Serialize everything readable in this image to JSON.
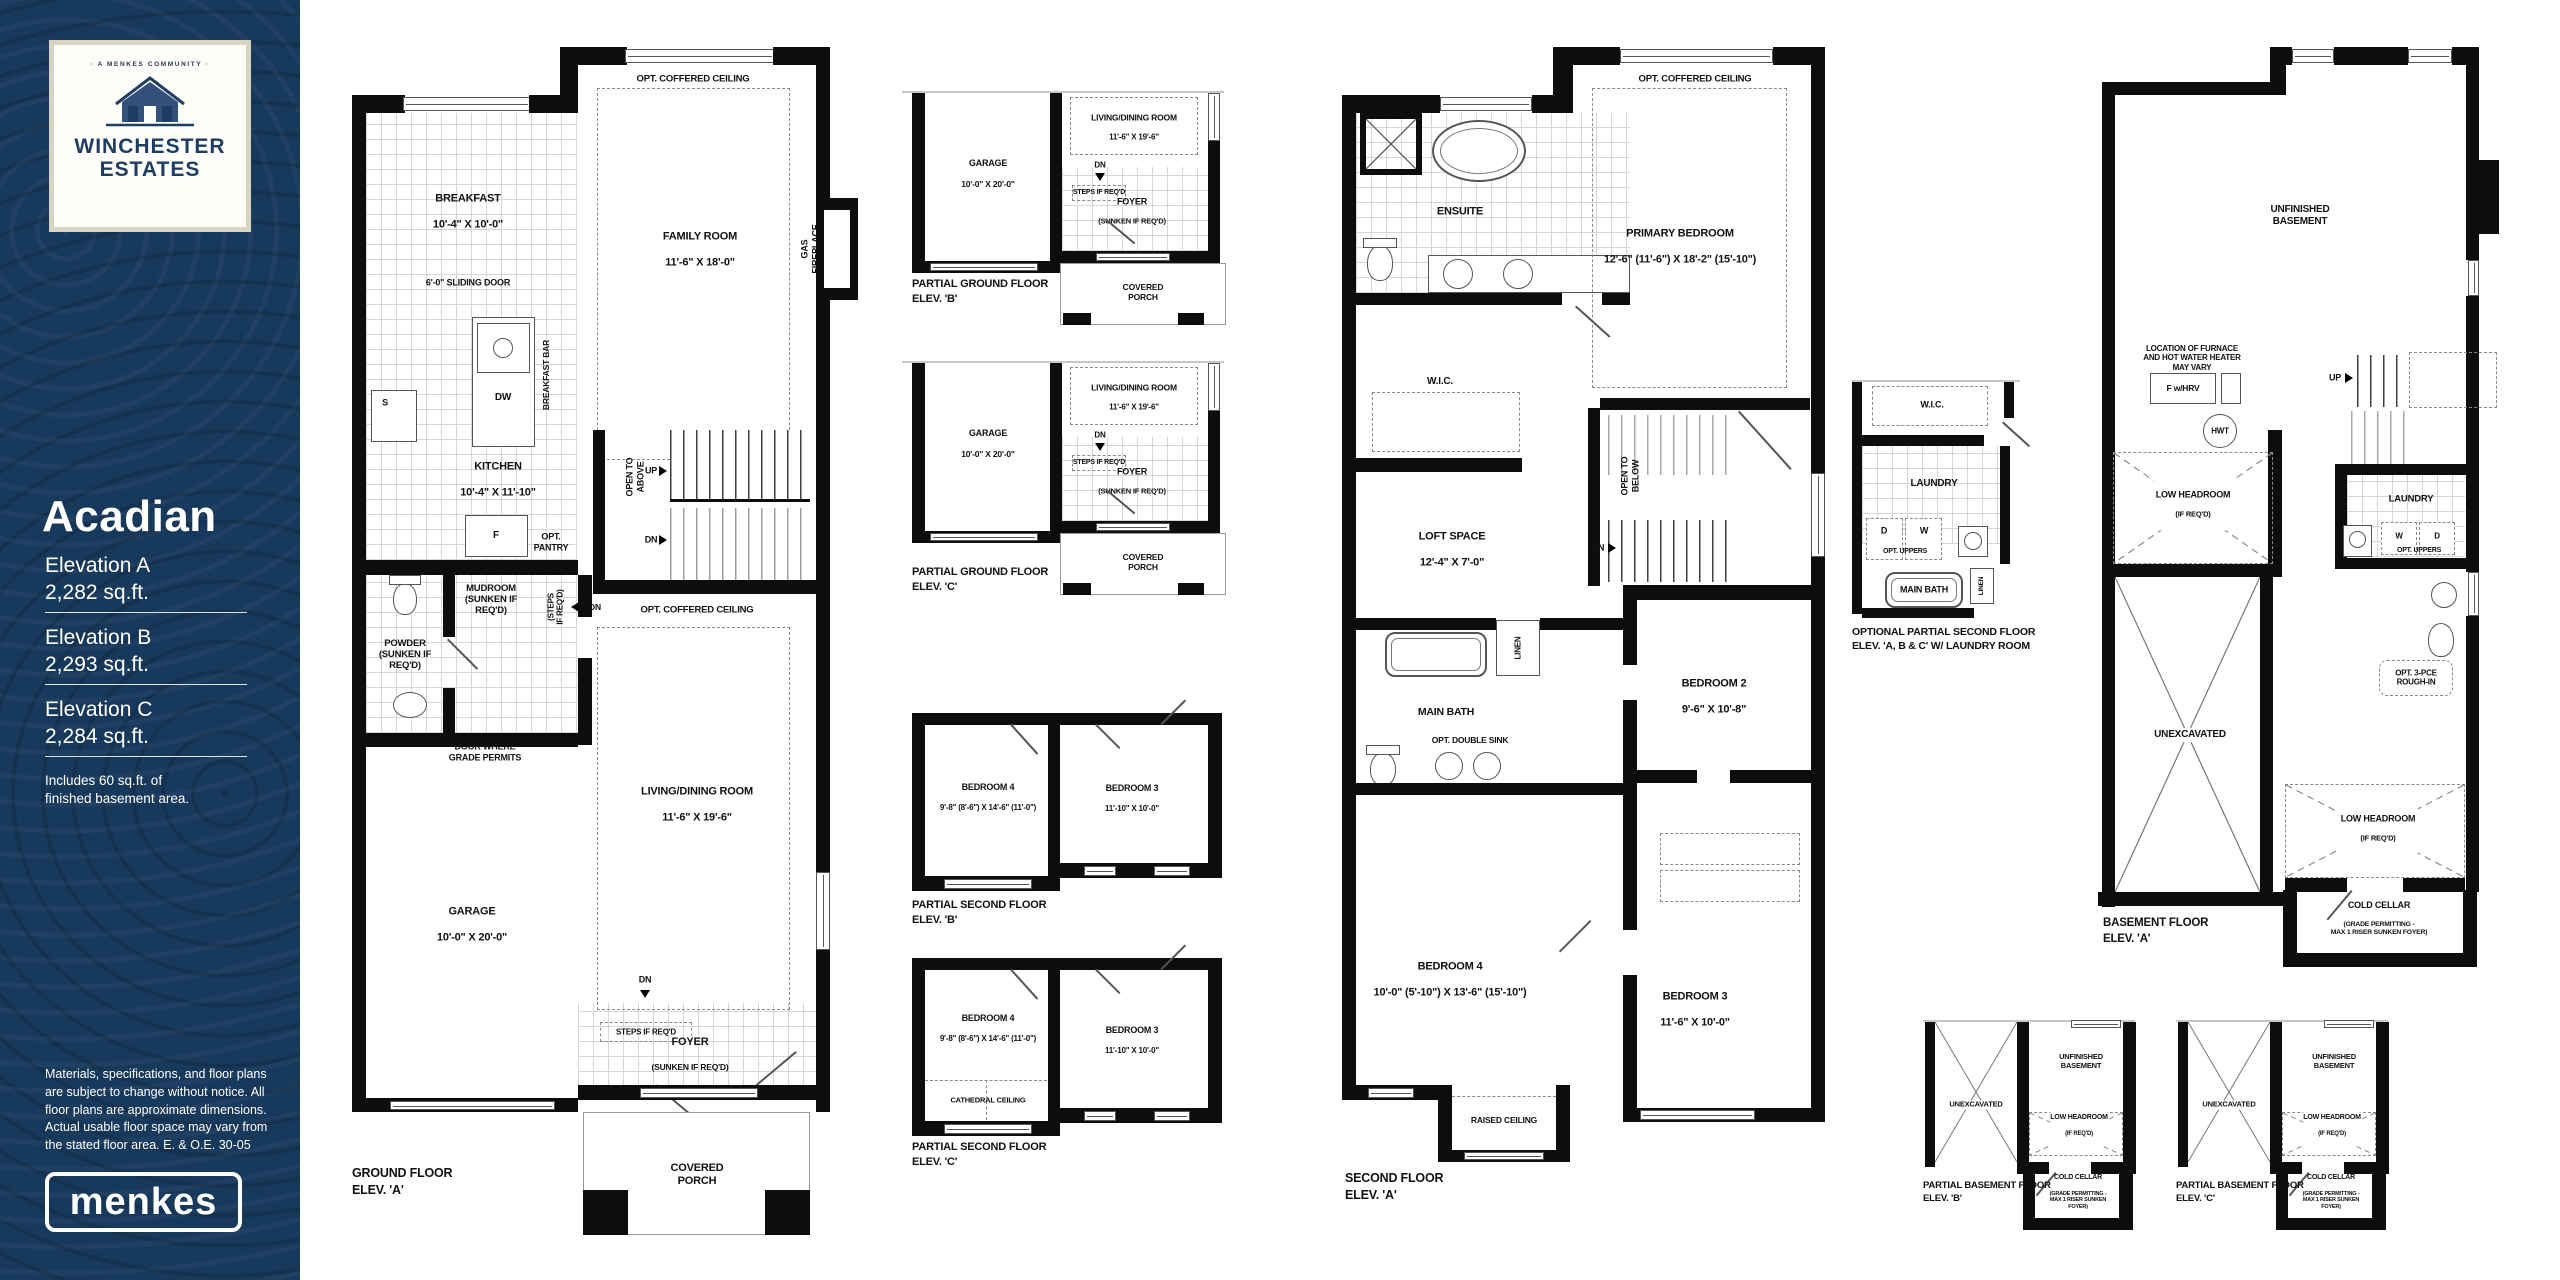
{
  "sidebar": {
    "bg_color": "#17395c",
    "card": {
      "tagline": "· A MENKES COMMUNITY ·",
      "community_line1": "WINCHESTER",
      "community_line2": "ESTATES"
    },
    "model_name": "Acadian",
    "elevations": [
      {
        "label": "Elevation A",
        "area": "2,282 sq.ft."
      },
      {
        "label": "Elevation B",
        "area": "2,293 sq.ft."
      },
      {
        "label": "Elevation C",
        "area": "2,284 sq.ft."
      }
    ],
    "basement_note": "Includes 60 sq.ft. of\nfinished basement area.",
    "disclaimer": "Materials, specifications, and floor plans\nare subject to change without notice. All\nfloor plans are approximate dimensions.\nActual usable floor space may vary from\nthe stated floor area. E. & O.E. 30-05",
    "builder": "menkes"
  },
  "plans": {
    "ground_a": {
      "title1": "GROUND FLOOR",
      "title2": "ELEV. 'A'",
      "family_coffered": "OPT. COFFERED CEILING",
      "sliding_door": "6'-0\" SLIDING DOOR",
      "breakfast": "BREAKFAST",
      "breakfast_dim": "10'-4\" X 10'-0\"",
      "family": "FAMILY ROOM",
      "family_dim": "11'-6\" X 18'-0\"",
      "gas_fireplace": "GAS FIREPLACE",
      "breakfast_bar": "BREAKFAST BAR",
      "s": "S",
      "dw": "DW",
      "f": "F",
      "kitchen": "KITCHEN",
      "kitchen_dim": "10'-4\" X 11'-10\"",
      "opt_pantry": "OPT.\nPANTRY",
      "open_above": "OPEN TO\nABOVE",
      "up": "UP",
      "dn_stairs": "DN",
      "mudroom": "MUDROOM\n(SUNKEN IF\nREQ'D)",
      "steps_vert": "(STEPS\nIF REQ'D)",
      "dn_mud": "DN",
      "powder": "POWDER\n(SUNKEN IF\nREQ'D)",
      "living_coffered": "OPT. COFFERED CEILING",
      "living": "LIVING/DINING ROOM",
      "living_dim": "11'-6\" X 19'-6\"",
      "door_grade": "DOOR WHERE\nGRADE PERMITS",
      "garage": "GARAGE",
      "garage_dim": "10'-0\" X 20'-0\"",
      "dn_foyer": "DN",
      "steps": "STEPS IF REQ'D",
      "foyer": "FOYER",
      "foyer_sub": "(SUNKEN IF REQ'D)",
      "porch": "COVERED\nPORCH"
    },
    "partial_ground_b": {
      "title1": "PARTIAL GROUND FLOOR",
      "title2": "ELEV. 'B'",
      "garage": "GARAGE",
      "garage_dim": "10'-0\" X 20'-0\"",
      "living": "LIVING/DINING ROOM",
      "living_dim": "11'-6\" X 19'-6\"",
      "dn": "DN",
      "steps": "STEPS IF REQ'D",
      "foyer": "FOYER",
      "foyer_sub": "(SUNKEN IF REQ'D)",
      "porch": "COVERED\nPORCH"
    },
    "partial_ground_c": {
      "title1": "PARTIAL GROUND FLOOR",
      "title2": "ELEV. 'C'",
      "garage": "GARAGE",
      "garage_dim": "10'-0\" X 20'-0\"",
      "living": "LIVING/DINING ROOM",
      "living_dim": "11'-6\" X 19'-6\"",
      "dn": "DN",
      "steps": "STEPS IF REQ'D",
      "foyer": "FOYER",
      "foyer_sub": "(SUNKEN IF REQ'D)",
      "porch": "COVERED\nPORCH"
    },
    "partial_second_b": {
      "title1": "PARTIAL SECOND FLOOR",
      "title2": "ELEV. 'B'",
      "bedroom4": "BEDROOM 4",
      "bedroom4_dim": "9'-8\" (8'-6\")  X 14'-6\" (11'-0\")",
      "bedroom3": "BEDROOM 3",
      "bedroom3_dim": "11'-10\" X 10'-0\""
    },
    "partial_second_c": {
      "title1": "PARTIAL SECOND FLOOR",
      "title2": "ELEV. 'C'",
      "bedroom4": "BEDROOM 4",
      "bedroom4_dim": "9'-8\" (8'-6\")  X 14'-6\" (11'-0\")",
      "bedroom3": "BEDROOM 3",
      "bedroom3_dim": "11'-10\" X 10'-0\"",
      "cathedral": "CATHEDRAL CEILING"
    },
    "second_a": {
      "title1": "SECOND FLOOR",
      "title2": "ELEV. 'A'",
      "coffered": "OPT. COFFERED CEILING",
      "ensuite": "ENSUITE",
      "primary": "PRIMARY BEDROOM",
      "primary_dim": "12'-6\" (11'-6\")  X 18'-2\" (15'-10\")",
      "wic": "W.I.C.",
      "loft": "LOFT SPACE",
      "loft_dim": "12'-4\" X 7'-0\"",
      "open_below": "OPEN TO\nBELOW",
      "dn": "DN",
      "linen": "LINEN",
      "main_bath": "MAIN BATH",
      "double_sink": "OPT. DOUBLE SINK",
      "bedroom2": "BEDROOM 2",
      "bedroom2_dim": "9'-6\" X 10'-8\"",
      "bedroom4": "BEDROOM 4",
      "bedroom4_dim": "10'-0\" (5'-10\")  X 13'-6\" (15'-10\")",
      "bedroom3": "BEDROOM 3",
      "bedroom3_dim": "11'-6\" X 10'-0\"",
      "raised": "RAISED CEILING"
    },
    "opt_second": {
      "title1": "OPTIONAL PARTIAL SECOND FLOOR",
      "title2": "ELEV. 'A, B & C' W/ LAUNDRY ROOM",
      "wic": "W.I.C.",
      "laundry": "LAUNDRY",
      "d": "D",
      "w": "W",
      "uppers": "OPT. UPPERS",
      "main_bath": "MAIN BATH",
      "linen": "LINEN"
    },
    "basement_a": {
      "title1": "BASEMENT FLOOR",
      "title2": "ELEV. 'A'",
      "unfinished": "UNFINISHED\nBASEMENT",
      "furnace_note": "LOCATION OF FURNACE\nAND HOT WATER HEATER\nMAY VARY",
      "f_hrv": "F w/HRV",
      "hwt": "HWT",
      "up": "UP",
      "low_headroom": "LOW HEADROOM",
      "low_headroom_sub": "(IF REQ'D)",
      "laundry": "LAUNDRY",
      "w": "W",
      "d": "D",
      "uppers": "OPT. UPPERS",
      "rough_in": "OPT. 3-PCE\nROUGH-IN",
      "unexcavated": "UNEXCAVATED",
      "lh2": "LOW HEADROOM",
      "lh2_sub": "(IF REQ'D)",
      "cold_cellar": "COLD CELLAR",
      "cold_sub": "(GRADE PERMITTING -\nMAX 1 RISER SUNKEN FOYER)"
    },
    "partial_basement_b": {
      "title1": "PARTIAL BASEMENT FLOOR",
      "title2": "ELEV. 'B'",
      "unexcavated": "UNEXCAVATED",
      "unfinished": "UNFINISHED\nBASEMENT",
      "low_headroom": "LOW HEADROOM",
      "low_sub": "(IF REQ'D)",
      "cold_cellar": "COLD CELLAR",
      "cold_sub": "(GRADE PERMITTING -\nMAX 1 RISER SUNKEN FOYER)"
    },
    "partial_basement_c": {
      "title1": "PARTIAL BASEMENT FLOOR",
      "title2": "ELEV. 'C'",
      "unexcavated": "UNEXCAVATED",
      "unfinished": "UNFINISHED\nBASEMENT",
      "low_headroom": "LOW HEADROOM",
      "low_sub": "(IF REQ'D)",
      "cold_cellar": "COLD CELLAR",
      "cold_sub": "(GRADE PERMITTING -\nMAX 1 RISER SUNKEN FOYER)"
    }
  }
}
